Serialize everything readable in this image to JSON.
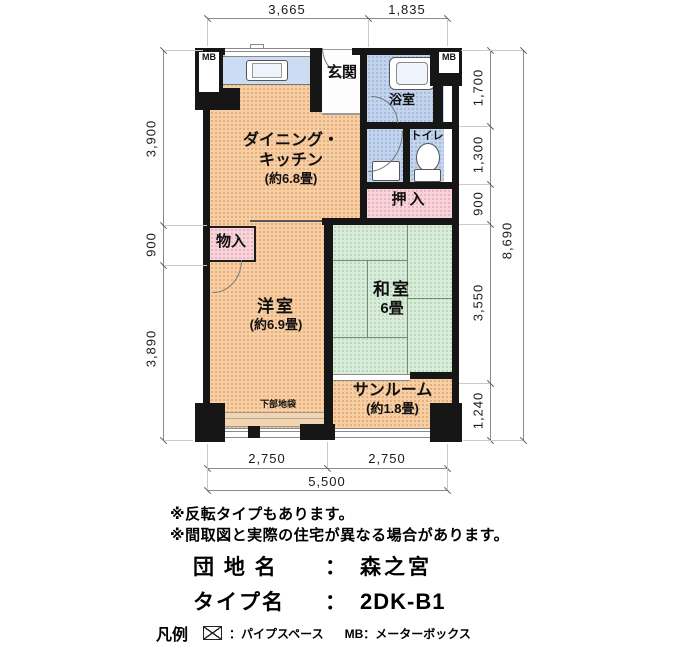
{
  "colors": {
    "wall": "#161616",
    "room_orange": "#f6cfa5",
    "room_orange_dot": "#e5a672",
    "room_green": "#d8ecd9",
    "room_green_dot": "#b4d4b7",
    "room_green_line": "#6f8f72",
    "room_blue": "#c4d4ed",
    "room_blue_dot": "#9db7de",
    "room_pink": "#f7d4da",
    "room_pink_dot": "#e7adbb",
    "counter_blue": "#ccdcf2"
  },
  "dimensions": {
    "top": [
      "3,665",
      "1,835"
    ],
    "left": [
      "3,900",
      "900",
      "3,890"
    ],
    "right": [
      "1,700",
      "1,300",
      "900",
      "3,550",
      "1,240"
    ],
    "right_total": "8,690",
    "bottom": [
      "2,750",
      "2,750"
    ],
    "bottom_total": "5,500"
  },
  "rooms": {
    "dk_line1": "ダイニング・",
    "dk_line2": "キッチン",
    "dk_size": "(約6.8畳)",
    "genkan": "玄関",
    "bathroom": "浴室",
    "toilet": "トイレ",
    "oshiire": "押入",
    "monoire": "物入",
    "western_room": "洋室",
    "western_room_size": "(約6.9畳)",
    "japanese_room": "和室",
    "japanese_room_size": "6畳",
    "sunroom": "サンルーム",
    "sunroom_size": "(約1.8畳)",
    "lower_cabinet": "下部地袋",
    "meter_box_left": "MB",
    "meter_box_right": "MB"
  },
  "notes": {
    "line1": "※反転タイプもあります。",
    "line2": "※間取図と実際の住宅が異なる場合があります。"
  },
  "info": {
    "estate_label": "団 地 名",
    "estate_sep": "：",
    "estate_value": "森之宮",
    "type_label": "タイプ名",
    "type_sep": "：",
    "type_value": "2DK-B1"
  },
  "legend": {
    "title": "凡例",
    "pipe_space_label": "：パイプスペース",
    "mb_label": "MB：メーターボックス"
  }
}
